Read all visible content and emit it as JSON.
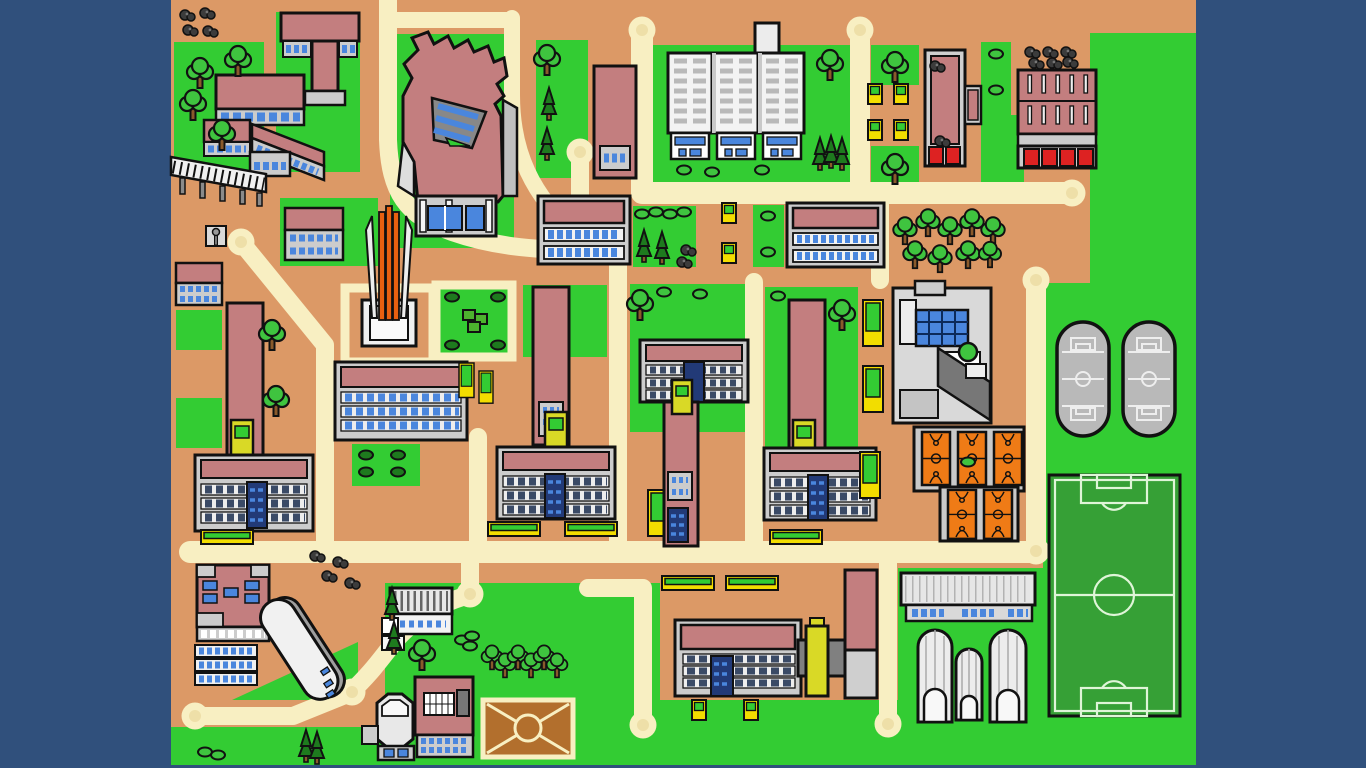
{
  "map": {
    "kind": "illustrated-campus-map",
    "description": "Cartoon-style top-down campus map with cream roads, lawns, buildings and sports facilities",
    "counts": {
      "road_circle_terminals": 12,
      "running_tracks": 2,
      "basketball_courts": 5,
      "soccer_fields": 1,
      "greenhouse_domes": 3,
      "dirt_fields": 1,
      "high_rise_towers": 3,
      "monuments": 1
    },
    "features": [
      {
        "name": "road-network",
        "label": "cream campus roads with round cul-de-sacs"
      },
      {
        "name": "soccer-field",
        "label": "dark green soccer pitch with line markings"
      },
      {
        "name": "running-tracks",
        "label": "two gray stadium-shaped mini pitches"
      },
      {
        "name": "basketball-complex",
        "label": "five orange courts on gray platform"
      },
      {
        "name": "greenhouses",
        "label": "three ribbed dome greenhouses"
      },
      {
        "name": "dirt-field",
        "label": "brown field with crossed diagonals and center circle"
      },
      {
        "name": "monument",
        "label": "orange and white spire on plaza"
      },
      {
        "name": "white-towers",
        "label": "three white high-rise blocks on lawn"
      },
      {
        "name": "boat-building",
        "label": "curved white auditorium"
      },
      {
        "name": "octagon-building",
        "label": "octagonal pavilion"
      },
      {
        "name": "pier",
        "label": "hatched boardwalk on posts"
      }
    ]
  },
  "colors": {
    "bg": "#30507c",
    "ground": "#dc9966",
    "grass": "#33cc33",
    "road": "#f8efc2",
    "road_inner": "#eedfa8",
    "roof": "#c37e7f",
    "wall": "#cccccc",
    "wall_light": "#f2f2f2",
    "wall_dark": "#9a9a9a",
    "window": "#4a86dd",
    "navy": "#223a77",
    "red": "#dd2222",
    "yellow": "#f2dd00",
    "tower_yellow": "#d9d926",
    "orange_court": "#ef7b16",
    "court_base": "#c9c9c9",
    "track": "#b9b9b9",
    "track_line": "#eeeeee",
    "pitch": "#36a036",
    "pitch_line": "#dff5d8",
    "dirt": "#b26f2d",
    "tree": "#3fc43f",
    "tree_dark": "#1e7a1e",
    "trunk": "#8a5a2b",
    "rock": "#3c3c3c",
    "outline": "#111111",
    "monument_orange": "#e86010"
  }
}
